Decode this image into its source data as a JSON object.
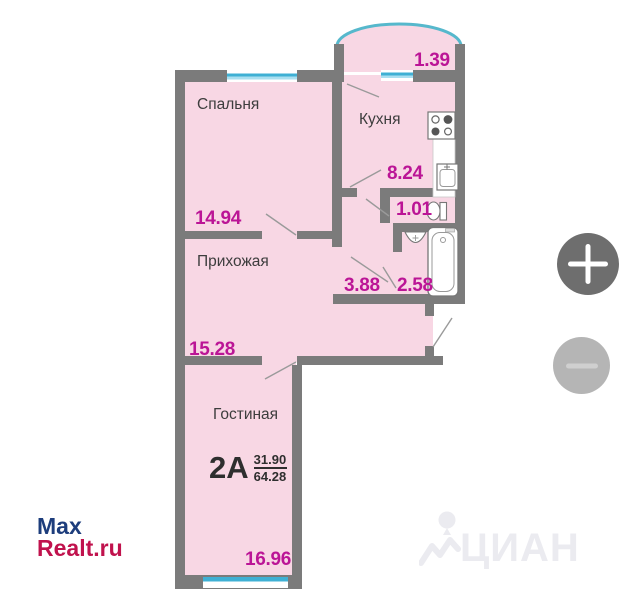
{
  "plan": {
    "apartment_label": {
      "type": "2А",
      "living_area": "31.90",
      "total_area": "64.28"
    },
    "rooms": {
      "bedroom": {
        "label": "Спальня",
        "area": "14.94"
      },
      "kitchen": {
        "label": "Кухня",
        "area": "8.24"
      },
      "hallway": {
        "label": "Прихожая",
        "area": "15.28"
      },
      "living_room": {
        "label": "Гостиная",
        "area": "16.96"
      },
      "balcony": {
        "area": "1.39"
      },
      "wc": {
        "area": "1.01"
      },
      "corridor": {
        "area": "3.88"
      },
      "bathroom": {
        "area": "2.58"
      }
    },
    "colors": {
      "wall": "#7b7b7b",
      "room_fill": "#f8d7e4",
      "area_value": "#bb1596",
      "room_label": "#3d3d3d",
      "window_accent": "#3fb0d4",
      "window_accent_light": "#a9dff0",
      "balcony_arc": "#56b8cc"
    }
  },
  "watermarks": {
    "maxrealt": {
      "line1": "Max",
      "line2": "Realt.ru",
      "color1": "#1d3d7c",
      "color2": "#c0124d"
    },
    "cian": {
      "text": "ЦИАН",
      "color": "#ebebf0"
    }
  },
  "controls": {
    "zoom_in_icon": "plus-icon",
    "zoom_out_icon": "minus-icon",
    "zoom_in_bg": "#6e6e6e",
    "zoom_out_bg": "#b5b5b5"
  }
}
